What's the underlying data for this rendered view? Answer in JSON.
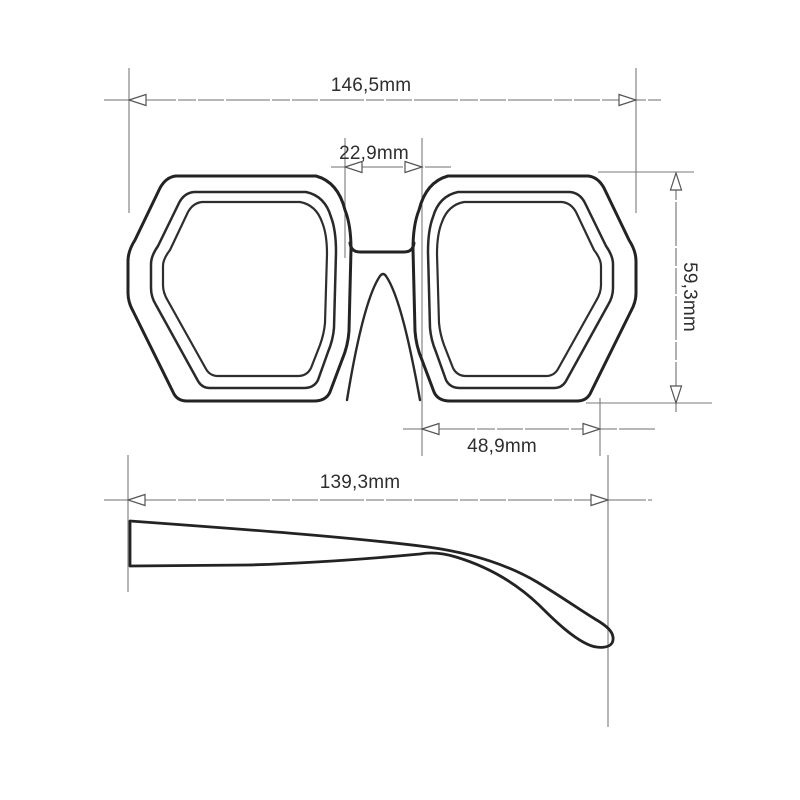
{
  "drawing": {
    "subject": "sunglasses-technical-drawing",
    "views": [
      "front-view",
      "temple-side-view"
    ]
  },
  "colors": {
    "background": "#ffffff",
    "frame_outline": "#232323",
    "dimension_lines": "#6f6f6f",
    "label_text": "#2e2e2e"
  },
  "dimensions": {
    "total_width": "146,5mm",
    "bridge_width": "22,9mm",
    "lens_height": "59,3mm",
    "lens_width": "48,9mm",
    "temple_length": "139,3mm"
  }
}
